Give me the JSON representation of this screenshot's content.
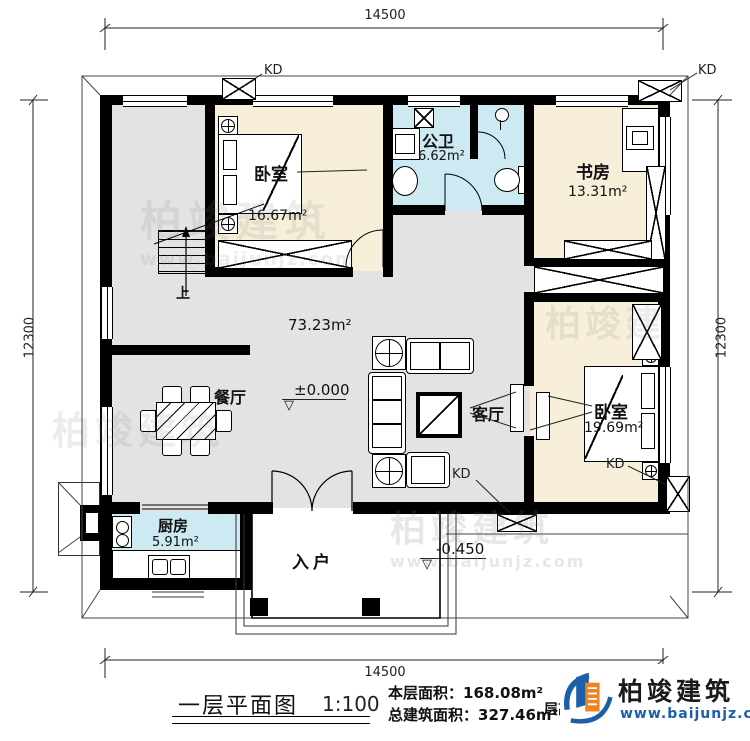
{
  "plan": {
    "dim_top": "14500",
    "dim_bottom": "14500",
    "dim_left": "12300",
    "dim_right": "12300",
    "rooms": {
      "bedroom1": {
        "name": "卧室",
        "area": "16.67m²"
      },
      "bathroom": {
        "name": "公卫",
        "area": "6.62m²"
      },
      "study": {
        "name": "书房",
        "area": "13.31m²"
      },
      "dining": {
        "name": "餐厅"
      },
      "living": {
        "name": "客厅"
      },
      "bedroom2": {
        "name": "卧室",
        "area": "19.69m²"
      },
      "kitchen": {
        "name": "厨房",
        "area": "5.91m²"
      },
      "entry": {
        "name": "入户"
      },
      "hall_area": "73.23m²"
    },
    "marks": {
      "level_main": "±0.000",
      "level_entry": "-0.450",
      "stair_up": "上",
      "kd": "KD",
      "triangle": "▽"
    }
  },
  "titleblock": {
    "title": "一层平面图",
    "scale": "1:100",
    "floor_area_label": "本层面积：",
    "floor_area_value": "168.08m²",
    "total_area_label": "总建筑面积：",
    "total_area_value": "327.46m²",
    "partial_note": "层高：3.",
    "brand": "柏竣建筑",
    "website": "www.baijunjz.com"
  },
  "watermark": {
    "brand": "柏竣建筑",
    "website": "www.baijunjz.com"
  },
  "colors": {
    "wall": "#000000",
    "room_warm": "#f7efda",
    "room_wet": "#cdeaf3",
    "hall": "#e3e3e3",
    "logo_blue": "#1a5fa8",
    "logo_orange": "#f08421"
  }
}
